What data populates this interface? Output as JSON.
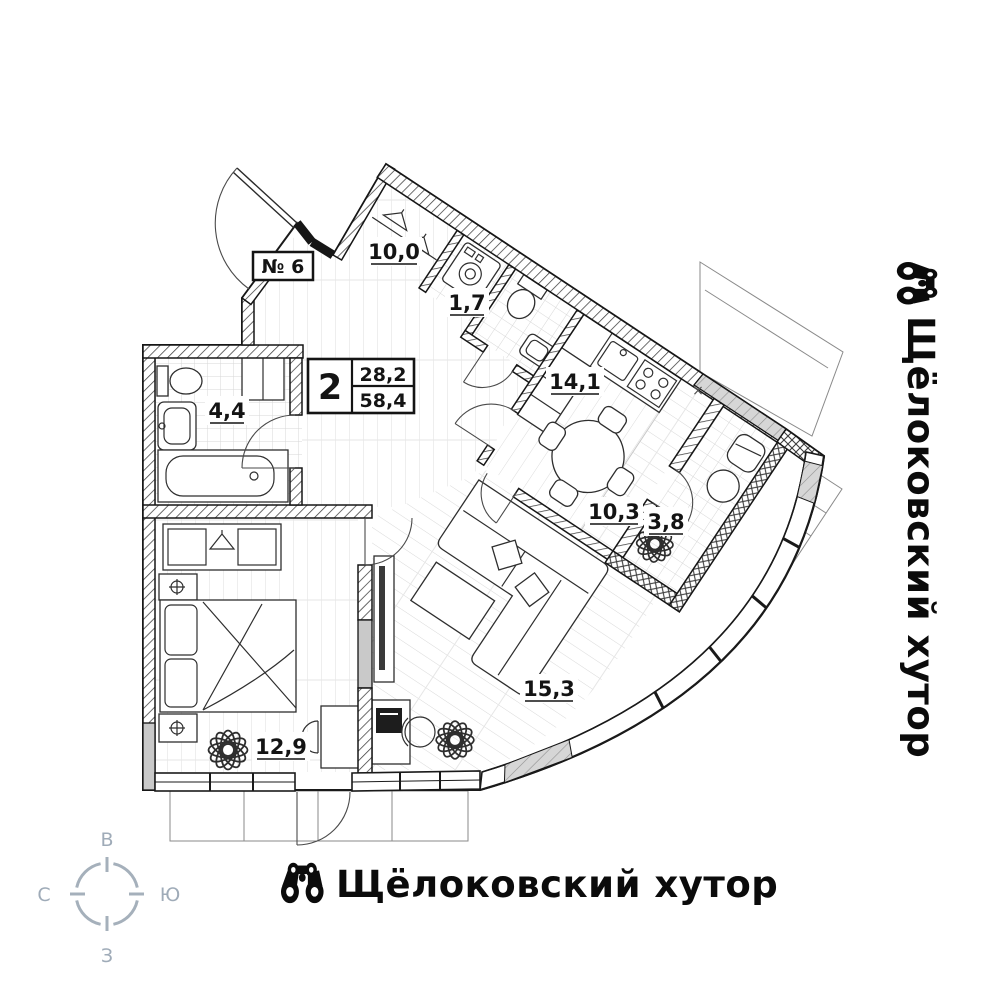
{
  "plan": {
    "unit_label": "№ 6",
    "summary": {
      "rooms_count": "2",
      "living_area": "28,2",
      "total_area": "58,4"
    },
    "rooms": [
      {
        "id": "hallway",
        "area": "10,0"
      },
      {
        "id": "wc",
        "area": "1,7"
      },
      {
        "id": "bathroom",
        "area": "4,4"
      },
      {
        "id": "kitchen",
        "area": "14,1"
      },
      {
        "id": "corridor",
        "area": "10,3"
      },
      {
        "id": "balcony",
        "area": "3,8"
      },
      {
        "id": "living",
        "area": "15,3"
      },
      {
        "id": "bedroom",
        "area": "12,9"
      }
    ],
    "cross_mark": "×"
  },
  "compass": {
    "top": "В",
    "right": "Ю",
    "bottom": "З",
    "left": "С",
    "color": "#9fabb8"
  },
  "brand": {
    "name": "Щёлоковский хутор",
    "color": "#0b0b0b"
  }
}
